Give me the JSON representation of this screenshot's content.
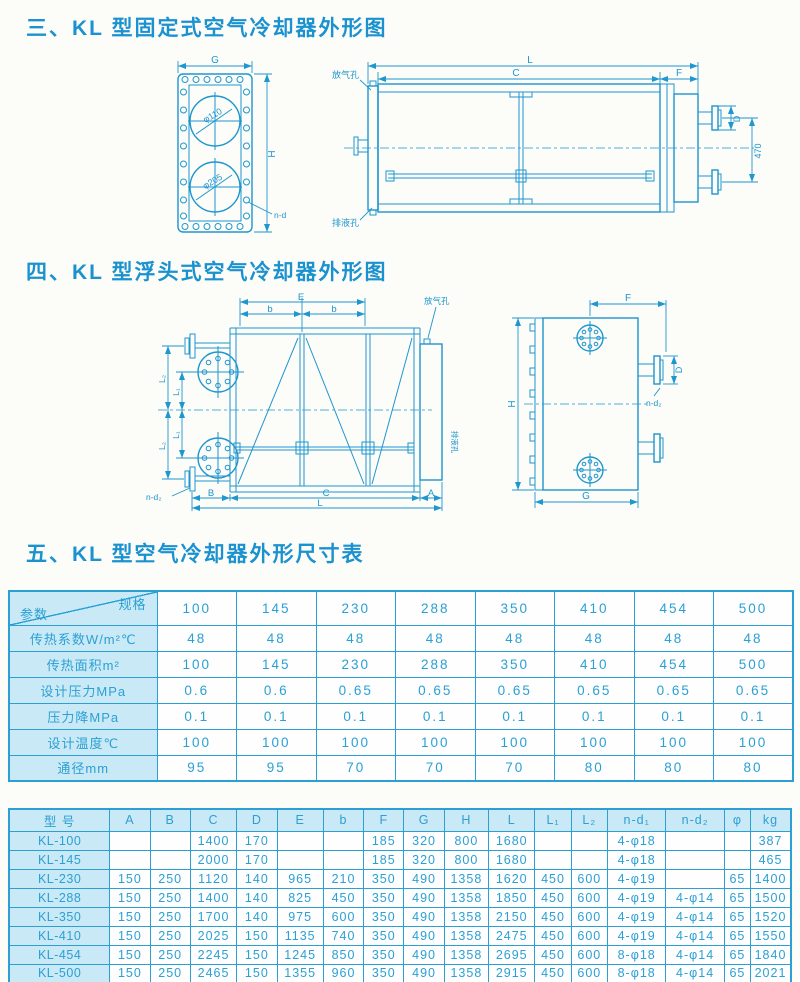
{
  "colors": {
    "ink": "#1e96cf",
    "table_border": "#2aa0d4",
    "label_cell_bg": "#c9e9f6",
    "page_bg": "#fcfcf8"
  },
  "sections": {
    "s3_title": "三、KL 型固定式空气冷却器外形图",
    "s4_title": "四、KL 型浮头式空气冷却器外形图",
    "s5_title": "五、KL 型空气冷却器外形尺寸表"
  },
  "drawing3": {
    "end_view": {
      "g": "G",
      "h": "H",
      "nd": "n-d",
      "phi_top": "φ110",
      "phi_bottom": "φ205"
    },
    "side_view": {
      "l": "L",
      "c": "C",
      "f": "F",
      "d": "D",
      "v470": "470",
      "vent": "放气孔",
      "drain": "排液孔"
    }
  },
  "drawing4": {
    "side_view": {
      "e": "E",
      "b": "b",
      "l1": "L₁",
      "l2": "L₂",
      "b_dim": "B",
      "c": "C",
      "l": "L",
      "a": "A",
      "nd2": "n-d₂",
      "vent": "放气孔",
      "drain": "排液孔"
    },
    "end_view": {
      "f": "F",
      "d": "D",
      "nd2": "n-d₂",
      "h": "H",
      "g": "G"
    }
  },
  "table1": {
    "corner": {
      "top": "规格",
      "bottom": "参数"
    },
    "columns": [
      "100",
      "145",
      "230",
      "288",
      "350",
      "410",
      "454",
      "500"
    ],
    "rows": [
      {
        "label": "传热系数W/m²℃",
        "values": [
          "48",
          "48",
          "48",
          "48",
          "48",
          "48",
          "48",
          "48"
        ]
      },
      {
        "label": "传热面积m²",
        "values": [
          "100",
          "145",
          "230",
          "288",
          "350",
          "410",
          "454",
          "500"
        ]
      },
      {
        "label": "设计压力MPa",
        "values": [
          "0.6",
          "0.6",
          "0.65",
          "0.65",
          "0.65",
          "0.65",
          "0.65",
          "0.65"
        ]
      },
      {
        "label": "压力降MPa",
        "values": [
          "0.1",
          "0.1",
          "0.1",
          "0.1",
          "0.1",
          "0.1",
          "0.1",
          "0.1"
        ]
      },
      {
        "label": "设计温度℃",
        "values": [
          "100",
          "100",
          "100",
          "100",
          "100",
          "100",
          "100",
          "100"
        ]
      },
      {
        "label": "通径mm",
        "values": [
          "95",
          "95",
          "70",
          "70",
          "70",
          "80",
          "80",
          "80"
        ]
      }
    ]
  },
  "table2": {
    "headers": [
      "型  号",
      "A",
      "B",
      "C",
      "D",
      "E",
      "b",
      "F",
      "G",
      "H",
      "L",
      "L₁",
      "L₂",
      "n-d₁",
      "n-d₂",
      "φ",
      "kg"
    ],
    "rows": [
      {
        "model": "KL-100",
        "values": [
          "",
          "",
          "1400",
          "170",
          "",
          "",
          "185",
          "320",
          "800",
          "1680",
          "",
          "",
          "4-φ18",
          "",
          "",
          "387"
        ]
      },
      {
        "model": "KL-145",
        "values": [
          "",
          "",
          "2000",
          "170",
          "",
          "",
          "185",
          "320",
          "800",
          "1680",
          "",
          "",
          "4-φ18",
          "",
          "",
          "465"
        ]
      },
      {
        "model": "KL-230",
        "values": [
          "150",
          "250",
          "1120",
          "140",
          "965",
          "210",
          "350",
          "490",
          "1358",
          "1620",
          "450",
          "600",
          "4-φ19",
          "",
          "65",
          "1400"
        ]
      },
      {
        "model": "KL-288",
        "values": [
          "150",
          "250",
          "1400",
          "140",
          "825",
          "450",
          "350",
          "490",
          "1358",
          "1850",
          "450",
          "600",
          "4-φ19",
          "4-φ14",
          "65",
          "1500"
        ]
      },
      {
        "model": "KL-350",
        "values": [
          "150",
          "250",
          "1700",
          "140",
          "975",
          "600",
          "350",
          "490",
          "1358",
          "2150",
          "450",
          "600",
          "4-φ19",
          "4-φ14",
          "65",
          "1520"
        ]
      },
      {
        "model": "KL-410",
        "values": [
          "150",
          "250",
          "2025",
          "150",
          "1135",
          "740",
          "350",
          "490",
          "1358",
          "2475",
          "450",
          "600",
          "4-φ19",
          "4-φ14",
          "65",
          "1550"
        ]
      },
      {
        "model": "KL-454",
        "values": [
          "150",
          "250",
          "2245",
          "150",
          "1245",
          "850",
          "350",
          "490",
          "1358",
          "2695",
          "450",
          "600",
          "8-φ18",
          "4-φ14",
          "65",
          "1840"
        ]
      },
      {
        "model": "KL-500",
        "values": [
          "150",
          "250",
          "2465",
          "150",
          "1355",
          "960",
          "350",
          "490",
          "1358",
          "2915",
          "450",
          "600",
          "8-φ18",
          "4-φ14",
          "65",
          "2021"
        ]
      }
    ]
  }
}
